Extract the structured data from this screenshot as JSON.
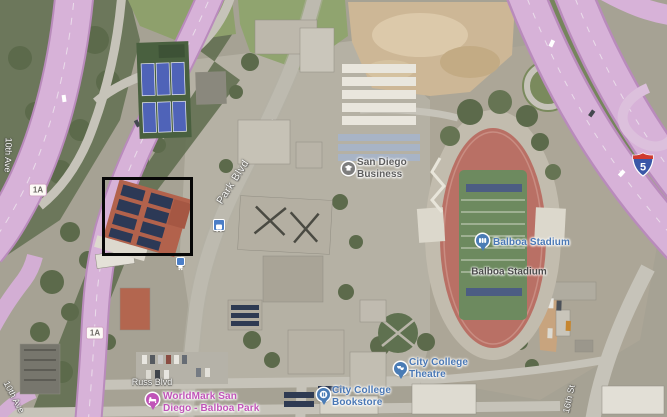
{
  "map_type": "satellite",
  "location": "San Diego City College / Balboa Park area",
  "labels": {
    "park_blvd": "Park Blvd",
    "russ_blvd": "Russ Blvd",
    "tenth_ave_upper": "10th Ave",
    "tenth_ave_lower": "10th Ave",
    "sixteenth_st": "16th St"
  },
  "shields": {
    "route1a_upper": "1A",
    "route1a_lower": "1A",
    "interstate5": "5"
  },
  "pois": {
    "san_diego_business": {
      "line1": "San Diego",
      "line2": "Business",
      "color": "#5d5d5d",
      "icon": "school-icon"
    },
    "balboa_stadium_pin": {
      "label": "Balboa Stadium",
      "color": "#4a78b5",
      "icon": "stadium-icon"
    },
    "balboa_stadium_area": {
      "label": "Balboa Stadium",
      "color": "#4b4b4b"
    },
    "city_college_theatre": {
      "line1": "City College",
      "line2": "Theatre",
      "color": "#4a78b5",
      "icon": "theater-icon"
    },
    "city_college_bookstore": {
      "line1": "City College",
      "line2": "Bookstore",
      "color": "#4a78b5",
      "icon": "store-icon"
    },
    "worldmark": {
      "line1": "WorldMark San",
      "line2": "Diego - Balboa Park",
      "color": "#c054b8",
      "icon": "lodging-icon"
    }
  },
  "icons": [
    "bus-station-icon",
    "bus-station-icon-small",
    "interstate-5-shield-icon"
  ],
  "annotation": {
    "type": "highlight-rectangle",
    "color": "#070707",
    "target": "building with rooftop solar panels"
  },
  "colors": {
    "highway_overlay": "#d7b2d8",
    "highway_edge": "#b98bbc",
    "poi_blue": "#4a78b5",
    "poi_pink": "#c054b8",
    "track_red": "#b97065",
    "field_green": "#6d8a5f",
    "interstate_red": "#cf3a30",
    "interstate_blue": "#3a57a7"
  }
}
